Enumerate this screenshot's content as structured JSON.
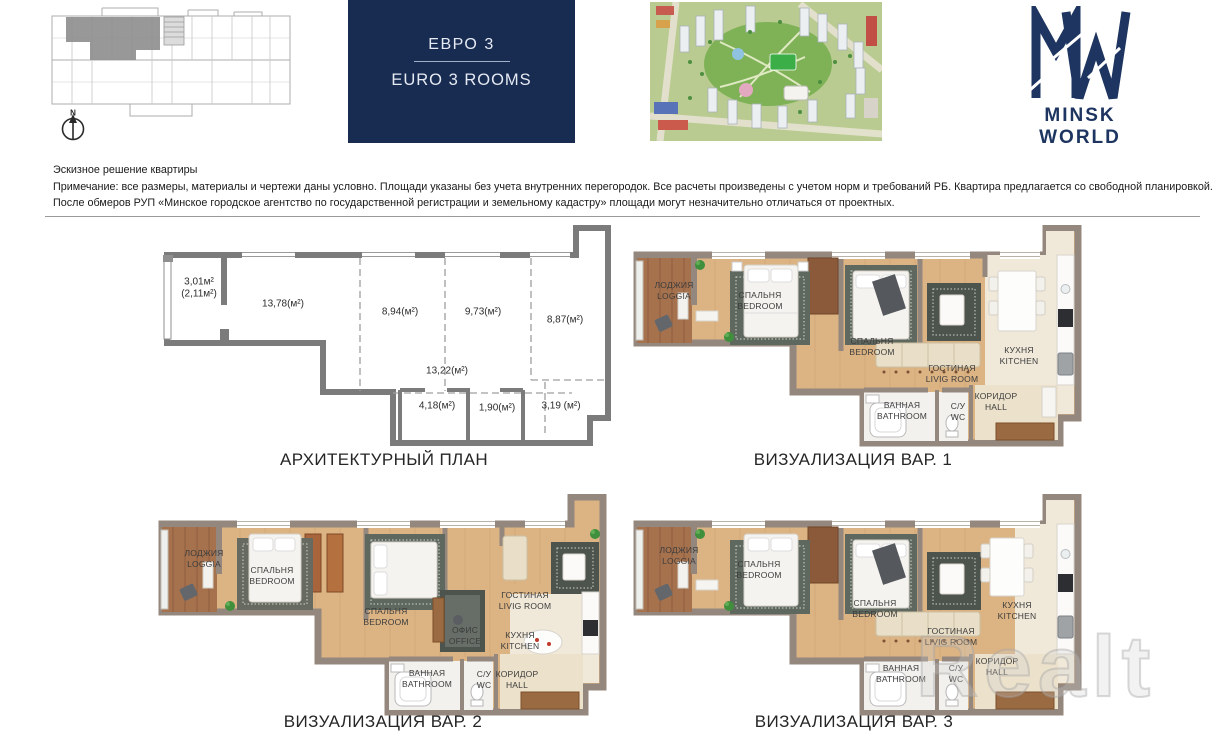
{
  "header": {
    "building_plan": {
      "north_label": "N"
    },
    "title_box": {
      "line1": "ЕВРО 3",
      "line2": "EURO 3 ROOMS"
    },
    "logo": {
      "text": "MINSK WORLD"
    }
  },
  "disclaimer": {
    "title": "Эскизное решение квартиры",
    "line2": "Примечание: все размеры, материалы и чертежи даны условно. Площади указаны без учета внутренних перегородок. Все расчеты произведены с учетом норм и требований РБ. Квартира предлагается со свободной планировкой.",
    "line3": "После обмеров РУП «Минское городское агентство по государственной регистрации и земельному кадастру» площади могут незначительно отличаться от проектных."
  },
  "plans": {
    "arch": {
      "caption": "АРХИТЕКТУРНЫЙ ПЛАН",
      "areas": [
        {
          "label": "3,01м²",
          "sub": "(2,11м²)"
        },
        {
          "label": "13,78(м²)"
        },
        {
          "label": "8,94(м²)"
        },
        {
          "label": "9,73(м²)"
        },
        {
          "label": "8,87(м²)"
        },
        {
          "label": "13,22(м²)"
        },
        {
          "label": "4,18(м²)"
        },
        {
          "label": "1,90(м²)"
        },
        {
          "label": "3,19 (м²)"
        }
      ]
    },
    "viz1": {
      "caption": "ВИЗУАЛИЗАЦИЯ ВАР. 1",
      "rooms": [
        {
          "ru": "ЛОДЖИЯ",
          "en": "LOGGIA"
        },
        {
          "ru": "СПАЛЬНЯ",
          "en": "BEDROOM"
        },
        {
          "ru": "СПАЛЬНЯ",
          "en": "BEDROOM"
        },
        {
          "ru": "ГОСТИНАЯ",
          "en": "LIVIG ROOM"
        },
        {
          "ru": "КУХНЯ",
          "en": "KITCHEN"
        },
        {
          "ru": "ВАННАЯ",
          "en": "BATHROOM"
        },
        {
          "ru": "С/У",
          "en": "WC"
        },
        {
          "ru": "КОРИДОР",
          "en": "HALL"
        }
      ]
    },
    "viz2": {
      "caption": "ВИЗУАЛИЗАЦИЯ ВАР. 2",
      "rooms": [
        {
          "ru": "ЛОДЖИЯ",
          "en": "LOGGIA"
        },
        {
          "ru": "СПАЛЬНЯ",
          "en": "BEDROOM"
        },
        {
          "ru": "СПАЛЬНЯ",
          "en": "BEDROOM"
        },
        {
          "ru": "ОФИС",
          "en": "OFFICE"
        },
        {
          "ru": "ГОСТИНАЯ",
          "en": "LIVIG ROOM"
        },
        {
          "ru": "КУХНЯ",
          "en": "KITCHEN"
        },
        {
          "ru": "ВАННАЯ",
          "en": "BATHROOM"
        },
        {
          "ru": "С/У",
          "en": "WC"
        },
        {
          "ru": "КОРИДОР",
          "en": "HALL"
        }
      ]
    },
    "viz3": {
      "caption": "ВИЗУАЛИЗАЦИЯ ВАР. 3",
      "rooms": [
        {
          "ru": "ЛОДЖИЯ",
          "en": "LOGGIA"
        },
        {
          "ru": "СПАЛЬНЯ",
          "en": "BEDROOM"
        },
        {
          "ru": "СПАЛЬНЯ",
          "en": "BEDROOM"
        },
        {
          "ru": "ГОСТИНАЯ",
          "en": "LIVIG ROOM"
        },
        {
          "ru": "КУХНЯ",
          "en": "KITCHEN"
        },
        {
          "ru": "ВАННАЯ",
          "en": "BATHROOM"
        },
        {
          "ru": "С/У",
          "en": "WC"
        },
        {
          "ru": "КОРИДОР",
          "en": "HALL"
        }
      ]
    }
  },
  "watermark": {
    "text": "Realt"
  },
  "colors": {
    "navy_box": "#182c52",
    "logo_navy": "#1d3560",
    "render_wall": "#94877e",
    "plan_wall": "#7b7b7b",
    "wood_floor": "#dcb383",
    "loggia_floor": "#a6724e",
    "highlight_unit": "#8f8f8f"
  }
}
